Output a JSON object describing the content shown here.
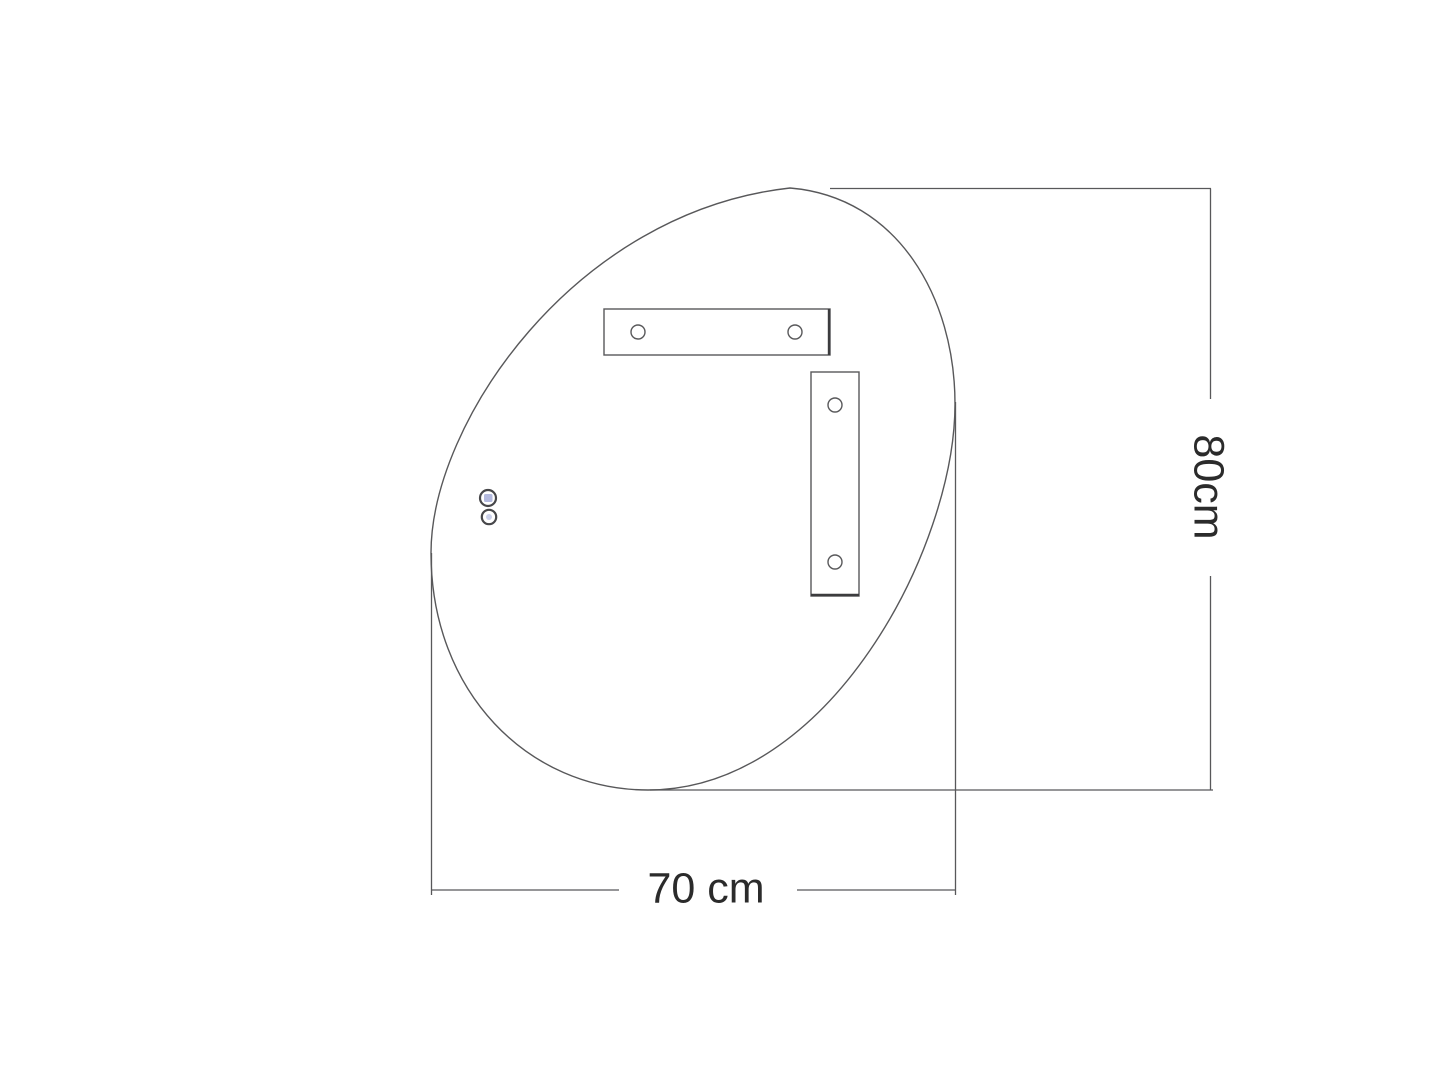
{
  "diagram": {
    "title": "pebble-shaped-mirror-rear-view-technical-drawing",
    "dimensions": {
      "height_label": "80cm",
      "width_label": "70 cm"
    },
    "parts": {
      "outline": "asymmetric organic mirror outline",
      "horizontal_bracket": "top mounting bracket with two screw holes",
      "vertical_bracket": "right mounting bracket with two screw holes",
      "sensors": "two touch sensor buttons"
    },
    "colors": {
      "background": "#ffffff",
      "line": "#58585a",
      "text": "#2b2b2b",
      "sensor_accent": "#b4badf",
      "sensor_accent_light": "#ccd1ea"
    }
  }
}
